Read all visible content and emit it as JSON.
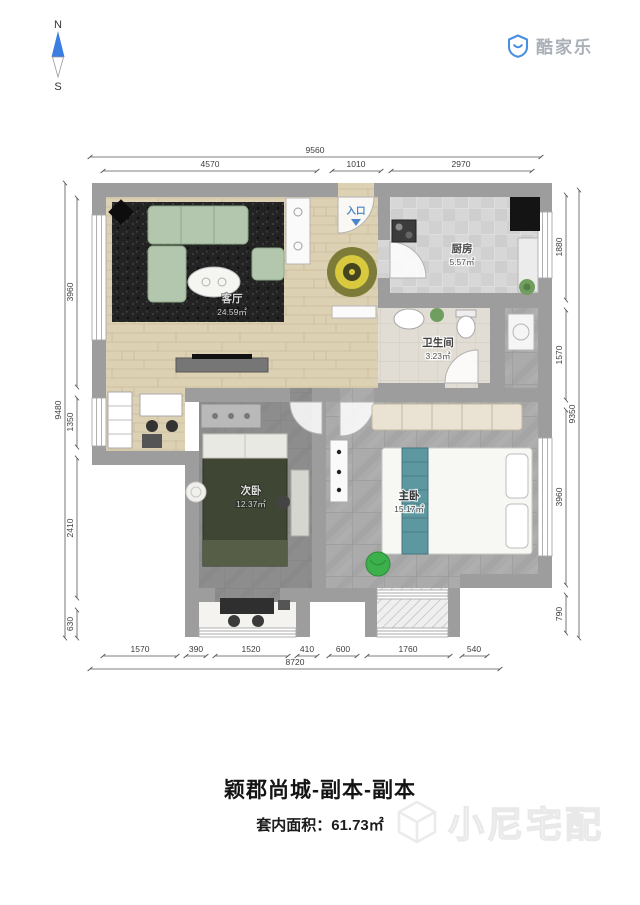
{
  "compass": {
    "north_label": "N",
    "south_label": "S"
  },
  "brand": {
    "logo_text": "酷家乐"
  },
  "plan": {
    "entry_label": "入口",
    "rooms": {
      "living": {
        "name": "客厅",
        "area": "24.59㎡"
      },
      "kitchen": {
        "name": "厨房",
        "area": "5.57㎡"
      },
      "bathroom": {
        "name": "卫生间",
        "area": "3.23㎡"
      },
      "bedroom2": {
        "name": "次卧",
        "area": "12.37㎡"
      },
      "master": {
        "name": "主卧",
        "area": "15.17㎡"
      }
    },
    "dims": {
      "top_total": "9560",
      "top": [
        "4570",
        "1010",
        "2970"
      ],
      "bottom": [
        "1570",
        "390",
        "1520",
        "410",
        "600",
        "1760",
        "540"
      ],
      "bottom_total": "8720",
      "left": [
        "3960",
        "1350",
        "2410",
        "630"
      ],
      "left_total": "9480",
      "right": [
        "1880",
        "1570",
        "3960",
        "790"
      ],
      "right_total": "9350"
    }
  },
  "footer": {
    "title": "颖郡尚城-副本-副本",
    "area_label": "套内面积：",
    "area_value": "61.73㎡",
    "watermark_text": "小尼宅配"
  },
  "colors": {
    "wall": "#9d9d9d",
    "accent_blue": "#4a90e2",
    "entry_blue": "#4a86c8",
    "sofa_green": "#b3c6ae",
    "bed_green": "#3f4634",
    "runner_teal": "#5d98a0",
    "beanbag_green": "#3cb04a"
  }
}
